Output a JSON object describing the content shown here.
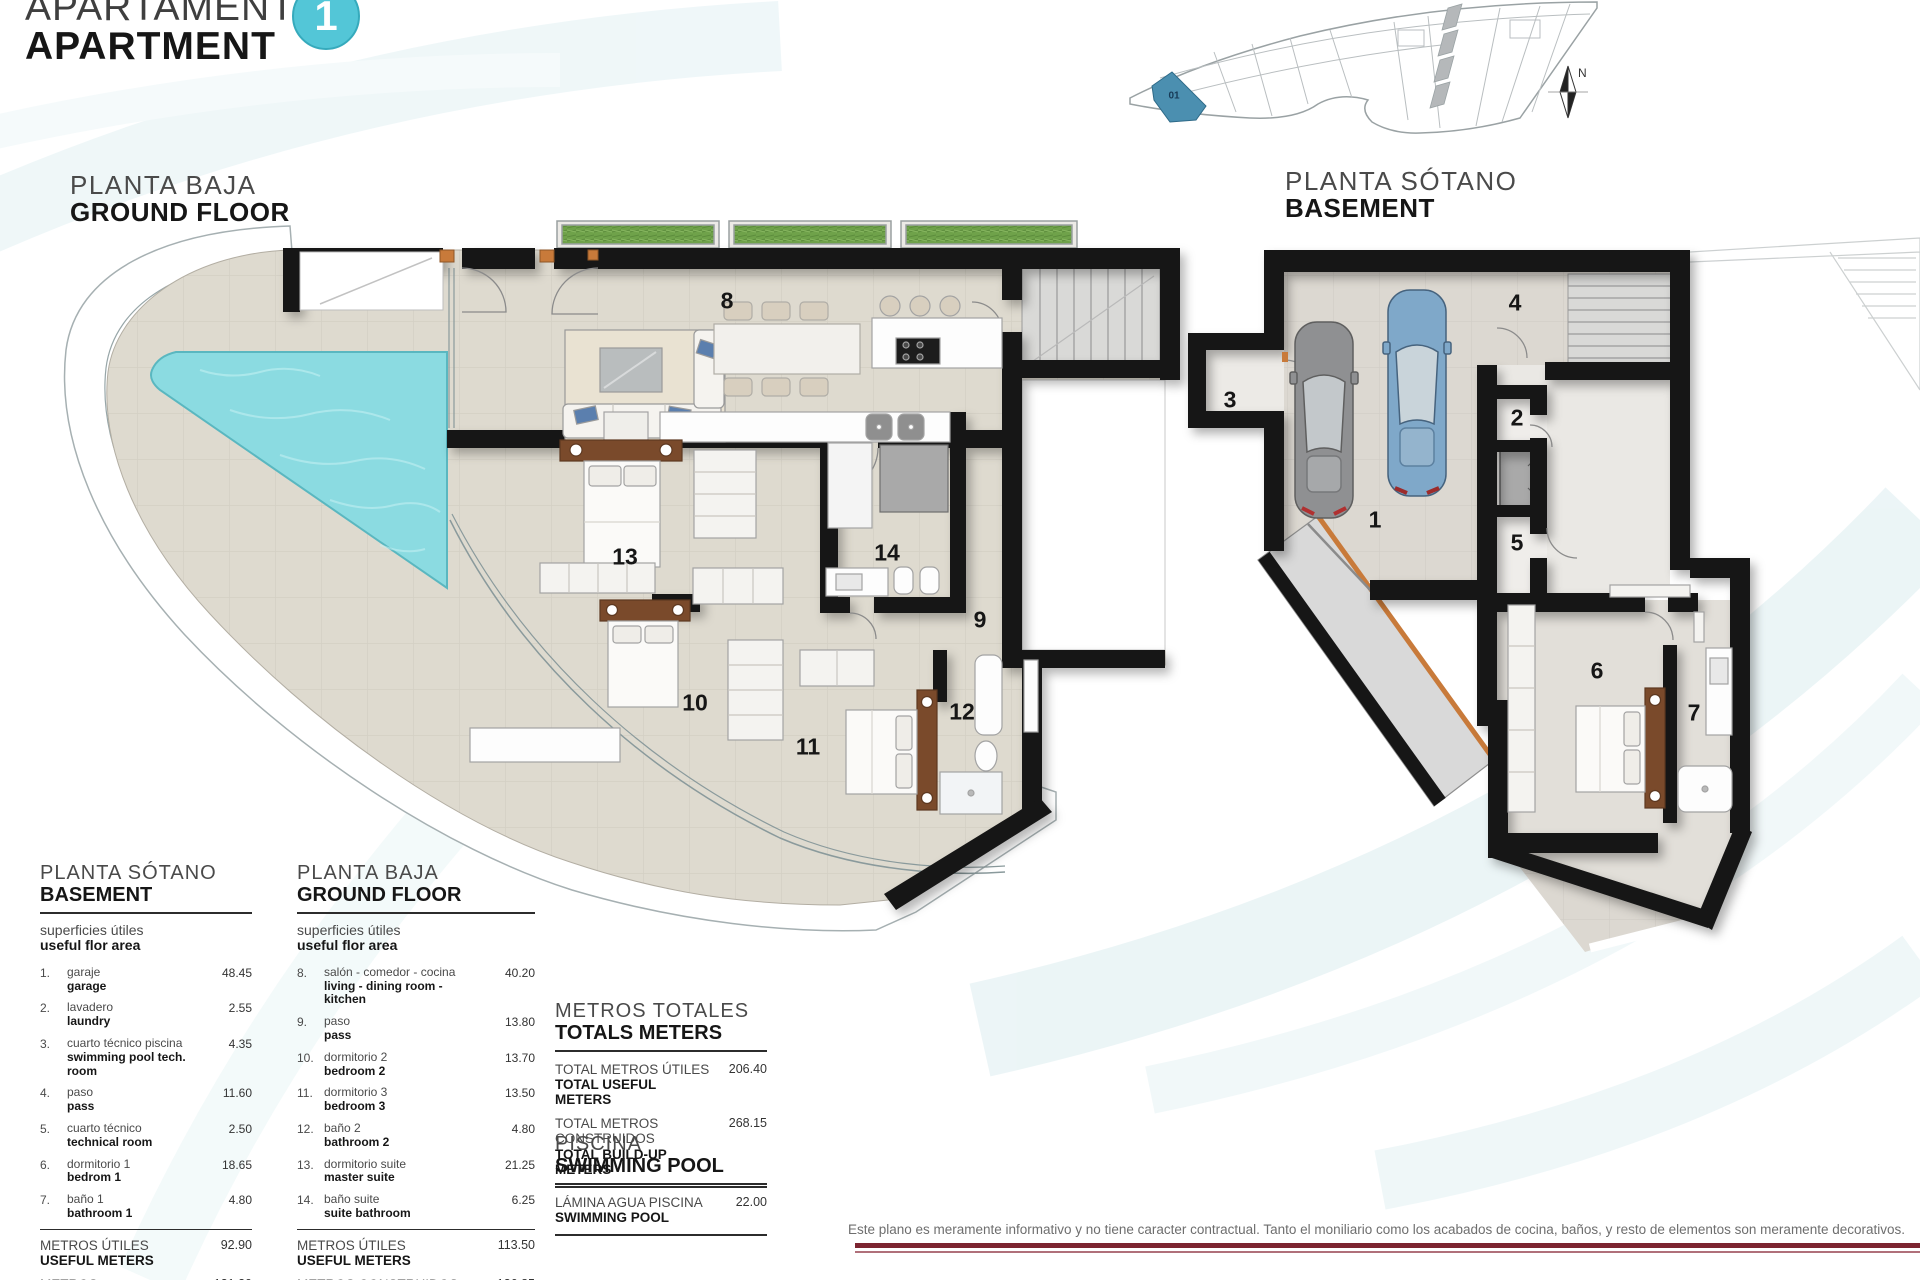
{
  "header": {
    "title_line1": "APARTAMENTO",
    "title_line2": "APARTMENT",
    "unit_number": "1"
  },
  "plans": {
    "ground": {
      "label_es": "PLANTA BAJA",
      "label_en": "GROUND FLOOR",
      "rooms": [
        "8",
        "9",
        "10",
        "11",
        "12",
        "13",
        "14"
      ]
    },
    "basement": {
      "label_es": "PLANTA SÓTANO",
      "label_en": "BASEMENT",
      "rooms": [
        "1",
        "2",
        "3",
        "4",
        "5",
        "6",
        "7"
      ]
    }
  },
  "site_plan": {
    "unit_label": "01",
    "north_label": "N"
  },
  "tables": {
    "basement": {
      "title_es": "PLANTA SÓTANO",
      "title_en": "BASEMENT",
      "subtitle_es": "superficies útiles",
      "subtitle_en": "useful flor area",
      "rows": [
        {
          "n": "1.",
          "es": "garaje",
          "en": "garage",
          "v": "48.45"
        },
        {
          "n": "2.",
          "es": "lavadero",
          "en": "laundry",
          "v": "2.55"
        },
        {
          "n": "3.",
          "es": "cuarto técnico piscina",
          "en": "swimming pool tech. room",
          "v": "4.35"
        },
        {
          "n": "4.",
          "es": "paso",
          "en": "pass",
          "v": "11.60"
        },
        {
          "n": "5.",
          "es": "cuarto técnico",
          "en": "technical room",
          "v": "2.50"
        },
        {
          "n": "6.",
          "es": "dormitorio 1",
          "en": "bedrom 1",
          "v": "18.65"
        },
        {
          "n": "7.",
          "es": "baño 1",
          "en": "bathroom 1",
          "v": "4.80"
        }
      ],
      "totals": [
        {
          "es": "METROS ÚTILES",
          "en": "USEFUL METERS",
          "v": "92.90"
        },
        {
          "es": "METROS CONSTRUIDOS",
          "en": "BUILD-UP METERS",
          "v": "131.30"
        }
      ]
    },
    "ground": {
      "title_es": "PLANTA BAJA",
      "title_en": "GROUND FLOOR",
      "subtitle_es": "superficies útiles",
      "subtitle_en": "useful flor area",
      "rows": [
        {
          "n": "8.",
          "es": "salón - comedor - cocina",
          "en": "living - dining room - kitchen",
          "v": "40.20"
        },
        {
          "n": "9.",
          "es": "paso",
          "en": "pass",
          "v": "13.80"
        },
        {
          "n": "10.",
          "es": "dormitorio 2",
          "en": "bedroom 2",
          "v": "13.70"
        },
        {
          "n": "11.",
          "es": "dormitorio 3",
          "en": "bedroom 3",
          "v": "13.50"
        },
        {
          "n": "12.",
          "es": "baño 2",
          "en": "bathroom 2",
          "v": "4.80"
        },
        {
          "n": "13.",
          "es": "dormitorio suite",
          "en": "master suite",
          "v": "21.25"
        },
        {
          "n": "14.",
          "es": "baño suite",
          "en": "suite bathroom",
          "v": "6.25"
        }
      ],
      "totals": [
        {
          "es": "METROS ÚTILES",
          "en": "USEFUL METERS",
          "v": "113.50"
        },
        {
          "es": "METROS CONSTRUIDOS",
          "en": "BUILD-UP METERS",
          "v": "136.85"
        }
      ]
    },
    "totals": {
      "title_es": "METROS TOTALES",
      "title_en": "TOTALS METERS",
      "rows": [
        {
          "es": "TOTAL METROS ÚTILES",
          "en": "TOTAL USEFUL METERS",
          "v": "206.40"
        },
        {
          "es": "TOTAL METROS CONSTRUIDOS",
          "en": "TOTAL BUILD-UP METERS",
          "v": "268.15"
        }
      ]
    },
    "pool": {
      "title_es": "PISCINA",
      "title_en": "SWIMMING POOL",
      "rows": [
        {
          "es": "LÁMINA AGUA PISCINA",
          "en": "SWIMMING POOL",
          "v": "22.00"
        }
      ]
    }
  },
  "footer": {
    "disclaimer": "Este plano es meramente informativo y no tiene caracter contractual. Tanto el moniliario como los acabados de cocina, baños, y resto de elementos son meramente decorativos."
  },
  "colors": {
    "accent": "#53c6d7",
    "maroon": "#7c2430",
    "pool_water": "#8bdbe1",
    "site_highlight": "#4b8fb0"
  }
}
